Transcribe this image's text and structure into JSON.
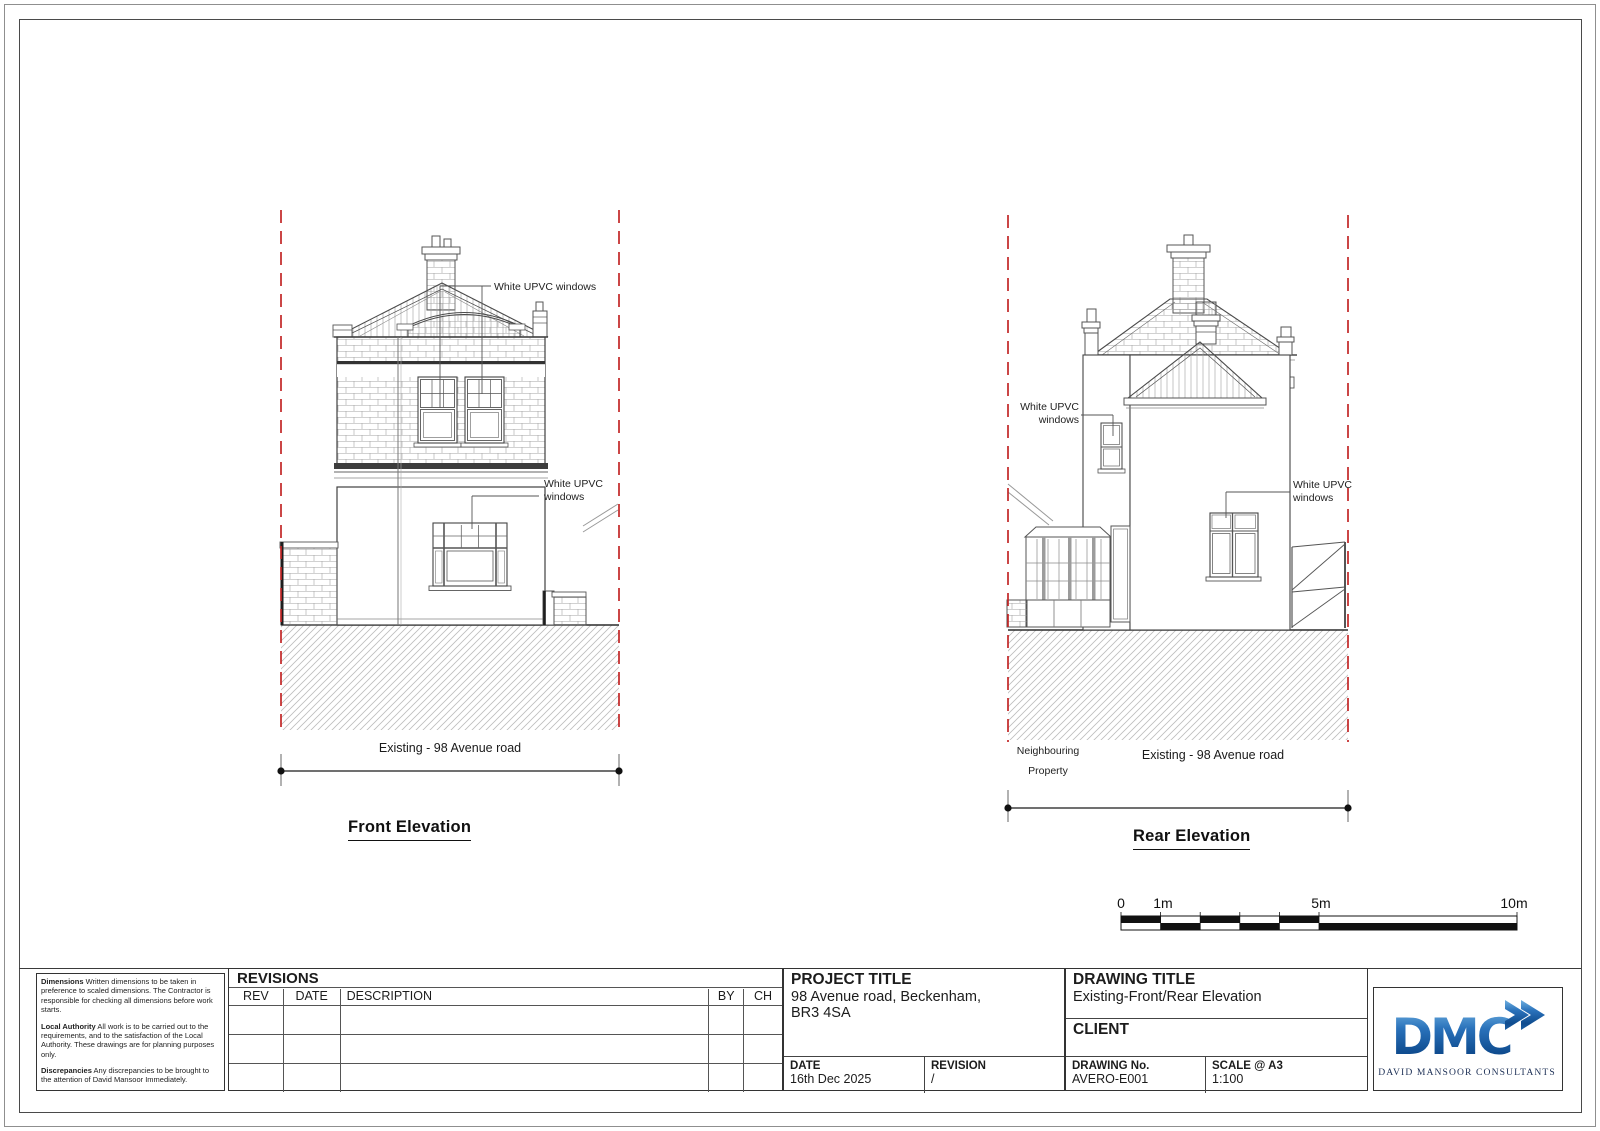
{
  "colors": {
    "boundary_red": "#c22626",
    "drawing_line": "#3a3a3a",
    "logo_blue_light": "#6fb0e0",
    "logo_blue_dark": "#0f4c8f",
    "logo_tagline_navy": "#1c2f55"
  },
  "front_elevation": {
    "title": "Front Elevation",
    "labels": {
      "upper_windows": "White UPVC windows",
      "ground_line1": "White UPVC",
      "ground_line2": "windows",
      "dimension": "Existing - 98 Avenue road"
    }
  },
  "rear_elevation": {
    "title": "Rear Elevation",
    "labels": {
      "left_line1": "White UPVC",
      "left_line2": "windows",
      "right_line1": "White UPVC",
      "right_line2": "windows",
      "neighbouring_line1": "Neighbouring",
      "neighbouring_line2": "Property",
      "dimension": "Existing - 98 Avenue road"
    }
  },
  "scale_bar": {
    "labels": [
      "0",
      "1m",
      "5m",
      "10m"
    ]
  },
  "notes": {
    "dimensions_title": "Dimensions",
    "dimensions_text": " Written dimensions to be taken in preference to scaled dimensions. The Contractor is responsible for checking all dimensions before work starts.",
    "local_authority_title": "Local Authority",
    "local_authority_text": " All work is to be carried out to the requirements, and to the  satisfaction of the Local Authority. These drawings are for planning purposes only.",
    "discrepancies_title": "Discrepancies",
    "discrepancies_text": " Any discrepancies to be brought to the attention of David Mansoor Immediately."
  },
  "revisions": {
    "title": "REVISIONS",
    "columns": {
      "rev": "REV",
      "date": "DATE",
      "description": "DESCRIPTION",
      "by": "BY",
      "ch": "CH"
    }
  },
  "title_block": {
    "project_title_label": "PROJECT TITLE",
    "project_address_line1": "98 Avenue road, Beckenham,",
    "project_address_line2": "BR3 4SA",
    "date_label": "DATE",
    "date_value": "16th Dec 2025",
    "revision_label": "REVISION",
    "revision_value": "/",
    "drawing_title_label": "DRAWING TITLE",
    "drawing_title_value": "Existing-Front/Rear Elevation",
    "client_label": "CLIENT",
    "drawing_no_label": "DRAWING No.",
    "drawing_no_value": "AVERO-E001",
    "scale_label": "SCALE @ A3",
    "scale_value": "1:100"
  },
  "logo": {
    "monogram": "DMC",
    "tagline": "DAVID MANSOOR CONSULTANTS"
  }
}
